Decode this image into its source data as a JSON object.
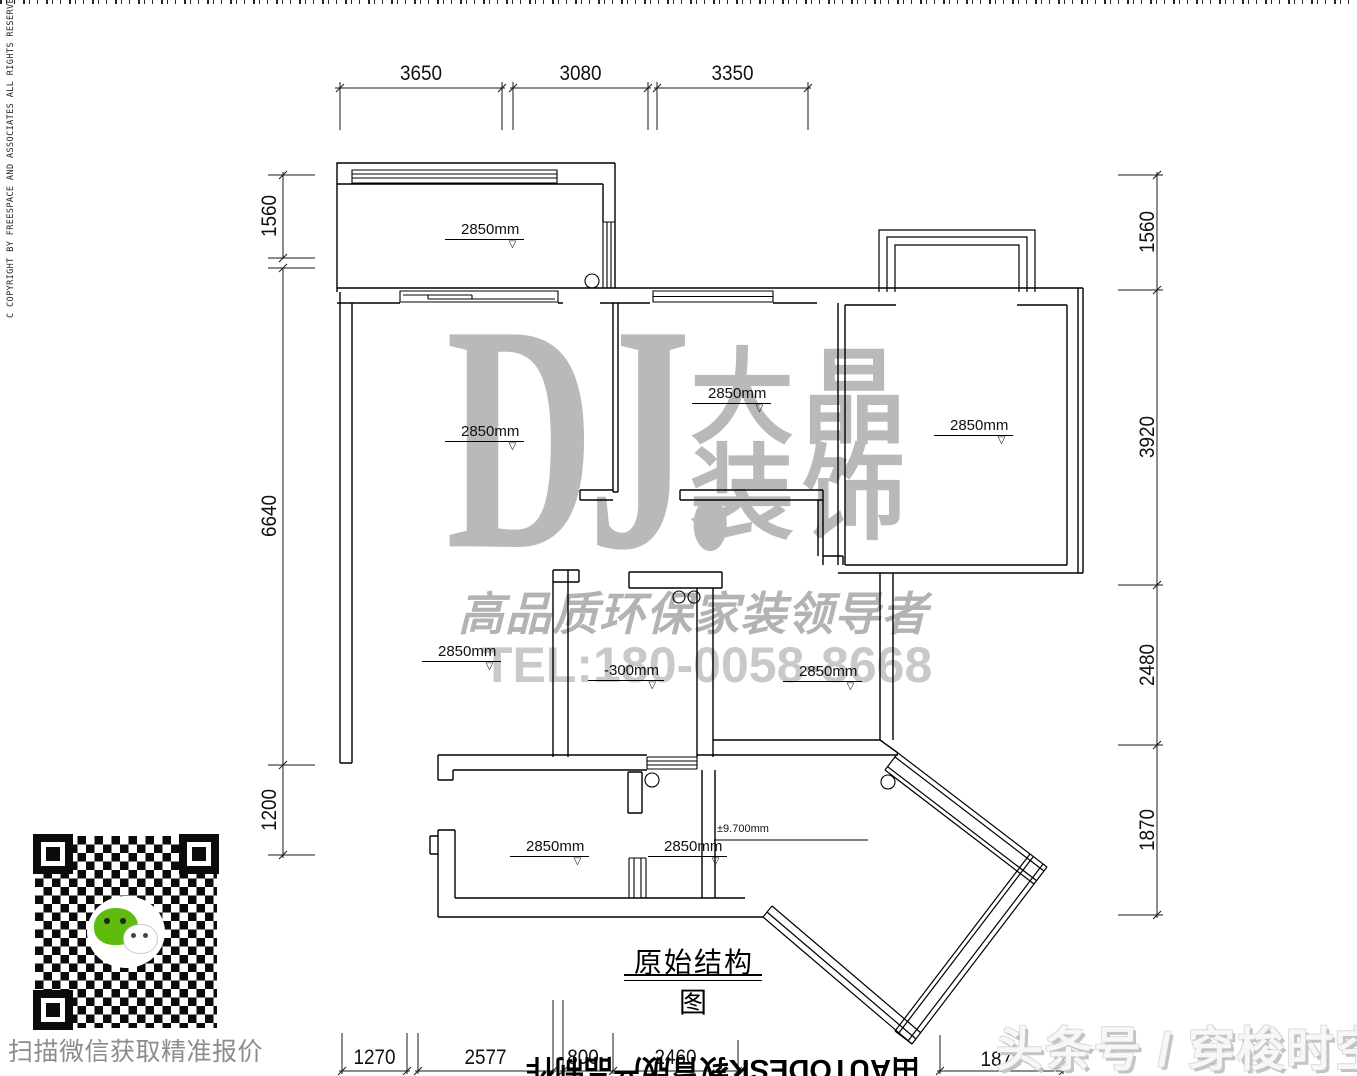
{
  "copyright_vertical": "C   COPYRIGHT BY FREESPACE AND ASSOCIATES  ALL RIGHTS RESERVED.",
  "watermark": {
    "brand_latin": "DJ.",
    "brand_cn_line1": "大晶",
    "brand_cn_line2": "装饰",
    "slogan": "高品质环保家装领导者",
    "phone": "TEL:180-0058-8668",
    "gray": "#b9b9b9"
  },
  "drawing": {
    "title": "原始结构图",
    "elevation_labels": [
      {
        "text": "2850mm"
      },
      {
        "text": "2850mm"
      },
      {
        "text": "2850mm"
      },
      {
        "text": "2850mm"
      },
      {
        "text": "2850mm"
      },
      {
        "text": "-300mm"
      },
      {
        "text": "2850mm"
      },
      {
        "text": "2850mm"
      },
      {
        "text": "2850mm"
      },
      {
        "text": "±9.700mm"
      }
    ]
  },
  "dimensions": {
    "top": [
      "3650",
      "3080",
      "3350"
    ],
    "left": [
      "1560",
      "6640",
      "1200"
    ],
    "right": [
      "1560",
      "3920",
      "2480",
      "1870"
    ],
    "bottom": [
      "1270",
      "2577",
      "800",
      "2460",
      "1875"
    ]
  },
  "footer": {
    "qr_caption": "扫描微信获取精准报价",
    "publisher": "头条号 / 穿梭时空",
    "cad_stamp": "由AUTODESK教育版产品制作"
  },
  "icons": {
    "down_triangle": "▽",
    "wechat": "wechat-icon"
  }
}
